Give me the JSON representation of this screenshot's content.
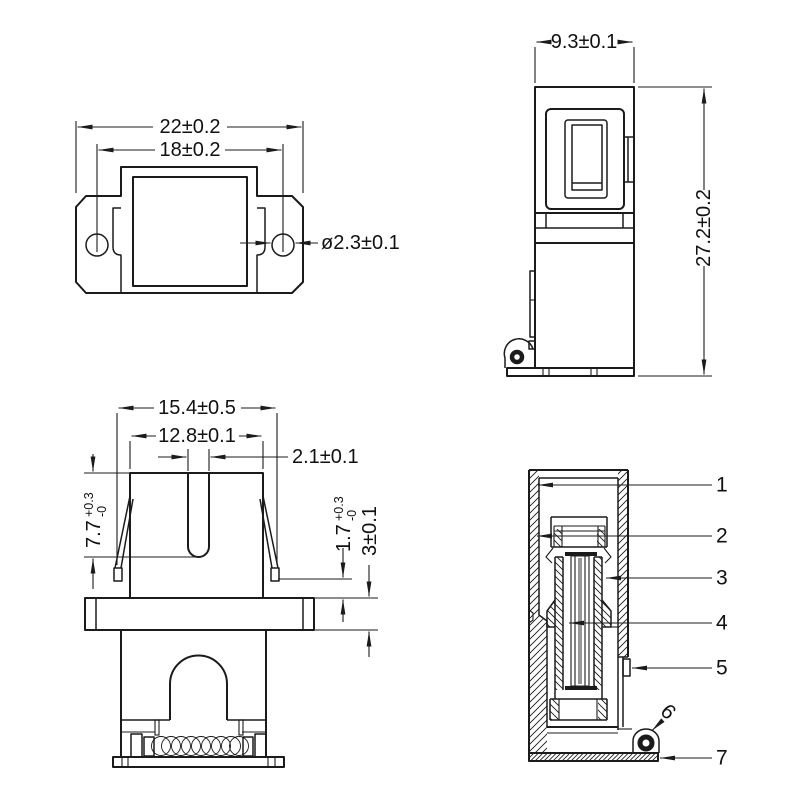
{
  "views": {
    "top": {
      "dim_overall": "22±0.2",
      "dim_hole_spacing": "18±0.2",
      "dim_hole_dia": "ø2.3±0.1"
    },
    "side": {
      "dim_width": "9.3±0.1",
      "dim_height": "27.2±0.2"
    },
    "front": {
      "dim_overall": "15.4±0.5",
      "dim_inner": "12.8±0.1",
      "dim_slot": "2.1±0.1",
      "dim_slot_depth": {
        "main": "7.7",
        "plus": "+0.3",
        "minus": "-0"
      },
      "dim_latch": {
        "main": "1.7",
        "plus": "+0.3",
        "minus": "-0"
      },
      "dim_flange": "3±0.1"
    },
    "section": {
      "labels": [
        "1",
        "2",
        "3",
        "4",
        "5",
        "6",
        "7"
      ]
    }
  },
  "colors": {
    "line": "#1b1b1b",
    "background": "#ffffff"
  }
}
